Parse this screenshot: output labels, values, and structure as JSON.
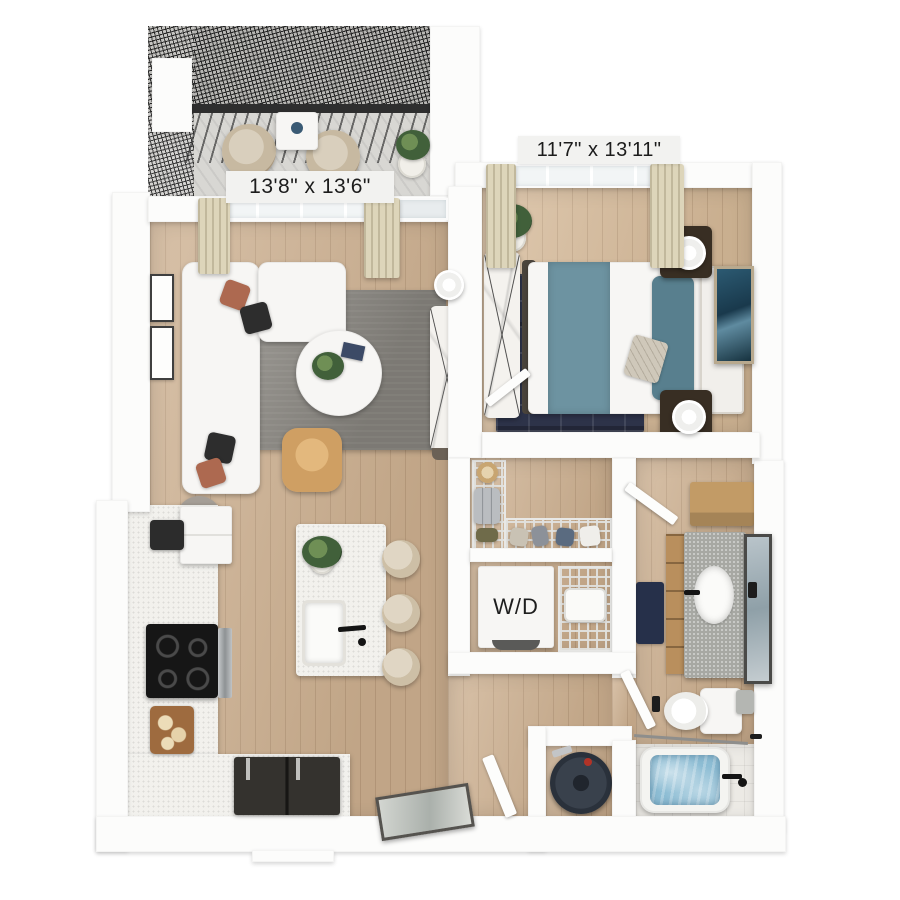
{
  "image": {
    "type": "3d-apartment-floor-plan-render",
    "background": "#ffffff"
  },
  "floorplan": {
    "balcony": {
      "furniture": [
        "patio-chair",
        "patio-chair",
        "patio-table",
        "potted-plant",
        "mesh-railing"
      ]
    },
    "living_room": {
      "dimensions_label": "13'8\" x 13'6\"",
      "furniture": [
        "sectional-sofa",
        "throw-pillows",
        "area-rug",
        "round-coffee-table",
        "accent-chair",
        "media-console",
        "table-lamp",
        "floor-lamp",
        "wall-art",
        "window",
        "curtains",
        "balcony-door"
      ]
    },
    "bedroom": {
      "dimensions_label": "11'7\" x 13'11\"",
      "furniture": [
        "bed",
        "teal-throw",
        "pillows",
        "headboard",
        "nightstand",
        "nightstand",
        "table-lamp",
        "table-lamp",
        "area-rug",
        "dresser",
        "potted-plant",
        "leaning-art",
        "window",
        "curtains"
      ]
    },
    "kitchen": {
      "furniture": [
        "cabinet-run",
        "upper-cabinets",
        "cooktop",
        "cutting-board",
        "kitchen-island",
        "island-sink",
        "faucet",
        "bar-stool",
        "bar-stool",
        "bar-stool",
        "potted-plant",
        "refrigerator"
      ]
    },
    "walk_in_closet": {
      "furniture": [
        "wire-shelving",
        "hanging-clothes",
        "hat",
        "suitcase"
      ]
    },
    "laundry_closet": {
      "washer_dryer_label": "W/D",
      "furniture": [
        "stacked-washer-dryer",
        "wire-shelving",
        "laundry-basket"
      ]
    },
    "bathroom": {
      "furniture": [
        "wood-shelf",
        "vanity",
        "sink",
        "faucet",
        "leaning-mirror",
        "bath-mat",
        "toilet",
        "trash-bin",
        "door"
      ]
    },
    "tub_room": {
      "furniture": [
        "bathtub",
        "tub-faucet",
        "shower-rod"
      ]
    },
    "utility_closet": {
      "furniture": [
        "water-heater"
      ]
    },
    "entry": {
      "furniture": [
        "leaning-mirror",
        "entry-door"
      ]
    }
  },
  "colors": {
    "background": "#ffffff",
    "wall": "#fcfcfb",
    "wood_floor": "#cbae8e",
    "balcony_concrete": "#d8d7d3",
    "mesh_railing": "#262626",
    "rug_gray": "#8a8781",
    "rug_navy": "#2d3349",
    "bed_teal": "#6d93a1",
    "pillow_rust": "#ad6950",
    "accent_chair_tan": "#cf9f63",
    "stool_beige": "#cdbfa6",
    "cabinet_wood": "#c29b66",
    "tub_water": "#8dbdd4",
    "cooktop_black": "#161616",
    "label_background": "#f2f2f0",
    "label_text": "#1c1c1c"
  }
}
